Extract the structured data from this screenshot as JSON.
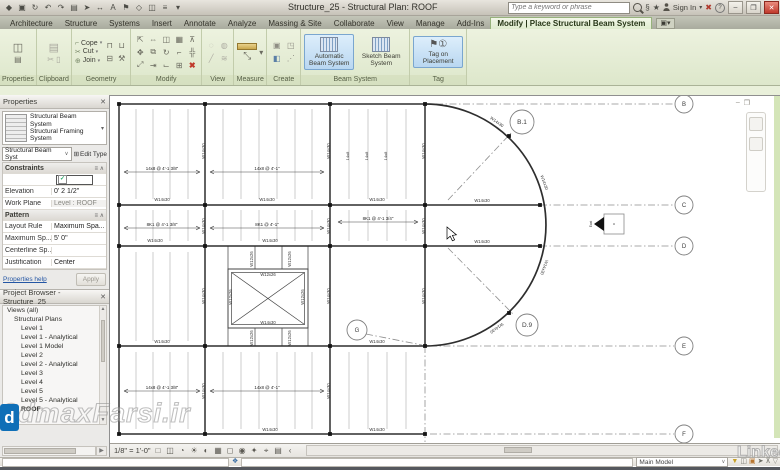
{
  "titlebar": {
    "title": "Structure_25 - Structural Plan: ROOF",
    "search_placeholder": "Type a keyword or phrase",
    "sign_in": "Sign In",
    "qat_icons": [
      "revit-app",
      "save",
      "sync",
      "undo",
      "redo",
      "print",
      "modify-arrow",
      "measure",
      "text",
      "tag-qat",
      "view-3d",
      "section",
      "thin-lines",
      "qat-customize"
    ],
    "window_buttons": [
      "minimize",
      "restore",
      "close"
    ]
  },
  "ribbon_tabs": [
    "Architecture",
    "Structure",
    "Systems",
    "Insert",
    "Annotate",
    "Analyze",
    "Massing & Site",
    "Collaborate",
    "View",
    "Manage",
    "Add-Ins"
  ],
  "contextual_tab": "Modify | Place Structural Beam System",
  "ribbon": {
    "panel_labels": [
      "Properties",
      "Clipboard",
      "Geometry",
      "Modify",
      "View",
      "Measure",
      "Create",
      "Beam System",
      "Tag"
    ],
    "geometry_buttons": [
      "Cope",
      "Cut",
      "Join"
    ],
    "beam_buttons": [
      {
        "label": "Automatic Beam System",
        "highlight": true
      },
      {
        "label": "Sketch Beam System",
        "highlight": false
      }
    ],
    "tag_button": "Tag on Placement"
  },
  "properties": {
    "title": "Properties",
    "type_name_line1": "Structural Beam System",
    "type_name_line2": "Structural Framing System",
    "selector": "Structural Beam Syst",
    "edit_type": "Edit Type",
    "rows": [
      {
        "t": "sec",
        "l": "Constraints"
      },
      {
        "t": "check",
        "l": "",
        "v": "✓"
      },
      {
        "t": "row",
        "l": "Elevation",
        "v": "0' 2 1/2\""
      },
      {
        "t": "rowg",
        "l": "Work Plane",
        "v": "Level : ROOF"
      },
      {
        "t": "sec",
        "l": "Pattern"
      },
      {
        "t": "row",
        "l": "Layout Rule",
        "v": "Maximum Spa..."
      },
      {
        "t": "row",
        "l": "Maximum Sp...",
        "v": "5' 0\""
      },
      {
        "t": "rowg",
        "l": "Centerline Sp...",
        "v": ""
      },
      {
        "t": "row",
        "l": "Justification",
        "v": "Center"
      }
    ],
    "help": "Properties help",
    "apply": "Apply"
  },
  "browser": {
    "title": "Project Browser - Structure_25",
    "items": [
      {
        "label": "Views (all)",
        "indent": 0
      },
      {
        "label": "Structural Plans",
        "indent": 1
      },
      {
        "label": "Level 1",
        "indent": 2
      },
      {
        "label": "Level 1 - Analytical",
        "indent": 2
      },
      {
        "label": "Level 1 Model",
        "indent": 2
      },
      {
        "label": "Level 2",
        "indent": 2
      },
      {
        "label": "Level 2 - Analytical",
        "indent": 2
      },
      {
        "label": "Level 3",
        "indent": 2
      },
      {
        "label": "Level 4",
        "indent": 2
      },
      {
        "label": "Level 5",
        "indent": 2
      },
      {
        "label": "Level 5 - Analytical",
        "indent": 2
      },
      {
        "label": "ROOF",
        "indent": 2,
        "selected": true
      }
    ]
  },
  "viewbar": {
    "scale": "1/8\" = 1'-0\"",
    "icons": [
      "visual-style",
      "show-crop",
      "crop-region",
      "sun-path",
      "shadows",
      "rendering",
      "temporary-hide",
      "reveal-hidden",
      "worksharing-display",
      "constraints",
      "analytical-model",
      "more"
    ]
  },
  "statusbar": {
    "main_model": "Main Model",
    "icons": [
      "worksets",
      "design-options",
      "editable-only",
      "press-drag",
      "exclude-options",
      "filter"
    ]
  },
  "watermarks": {
    "site": "3dmaxFarsi.ir",
    "linkedin": "Linked",
    "logo_letter": "d"
  },
  "plan": {
    "w": 670,
    "h": 348,
    "beams": [
      [
        9,
        8,
        315,
        8
      ],
      [
        9,
        109,
        315,
        109
      ],
      [
        9,
        150,
        315,
        150
      ],
      [
        9,
        250,
        315,
        250
      ],
      [
        9,
        338,
        315,
        338
      ],
      [
        315,
        109,
        430,
        109
      ],
      [
        315,
        150,
        430,
        150
      ],
      [
        9,
        8,
        9,
        338
      ],
      [
        95,
        8,
        95,
        338
      ],
      [
        220,
        8,
        220,
        338
      ],
      [
        315,
        8,
        315,
        250
      ]
    ],
    "arc": "M 315 8 A 121 121 0 0 1 315 250",
    "dashes": [
      [
        326,
        8,
        564,
        8
      ],
      [
        430,
        109,
        564,
        109
      ],
      [
        430,
        150,
        564,
        150
      ],
      [
        320,
        250,
        564,
        250
      ],
      [
        320,
        338,
        564,
        338
      ],
      [
        315,
        250,
        315,
        346
      ],
      [
        338,
        104,
        402,
        36
      ],
      [
        338,
        152,
        404,
        219
      ],
      [
        256,
        238,
        312,
        249
      ]
    ],
    "joists": [
      {
        "y1": 13,
        "y2": 103,
        "xs": [
          26,
          43,
          60,
          78,
          113,
          131,
          149,
          167,
          185,
          202,
          239,
          258,
          277,
          296
        ]
      },
      {
        "y1": 114,
        "y2": 145,
        "xs": [
          26,
          43,
          60,
          78,
          113,
          131,
          149,
          167,
          185,
          202,
          239,
          258,
          277,
          296
        ]
      },
      {
        "y1": 156,
        "y2": 245,
        "xs": [
          26,
          43,
          60,
          78
        ]
      },
      {
        "y1": 256,
        "y2": 333,
        "xs": [
          26,
          43,
          60,
          78,
          113,
          131,
          149,
          167,
          185,
          202,
          239,
          258,
          277,
          296
        ]
      }
    ],
    "stubs": [
      {
        "y1": 150,
        "y2": 173,
        "xs": [
          118,
          145,
          172,
          198
        ]
      },
      {
        "y1": 232,
        "y2": 250,
        "xs": [
          118,
          145,
          172,
          198
        ]
      }
    ],
    "dimtags": [
      [
        14,
        90,
        76,
        "14x8 @ 4'-1 3/8\""
      ],
      [
        100,
        214,
        76,
        "14x8 @ 4'-1\""
      ],
      [
        14,
        90,
        132,
        "8K1 @ 4'-1 3/8\""
      ],
      [
        100,
        214,
        132,
        "8K1 @ 4'-1\""
      ],
      [
        228,
        308,
        126,
        "8K1 @ 4'-1 3/4\""
      ],
      [
        14,
        90,
        295,
        "14x8 @ 4'-1 3/8\""
      ],
      [
        100,
        214,
        295,
        "14x8 @ 4'-1\""
      ]
    ],
    "labels": [
      [
        52,
        105,
        0,
        "W14x30"
      ],
      [
        157,
        105,
        0,
        "W14x30"
      ],
      [
        267,
        105,
        0,
        "W14x30"
      ],
      [
        372,
        106,
        0,
        "W14x30"
      ],
      [
        45,
        146,
        0,
        "W14x30"
      ],
      [
        160,
        146,
        0,
        "W14x30"
      ],
      [
        372,
        147,
        0,
        "W14x30"
      ],
      [
        52,
        247,
        0,
        "W14x30"
      ],
      [
        267,
        247,
        0,
        "W14x30"
      ],
      [
        160,
        335,
        0,
        "W14x30"
      ],
      [
        267,
        335,
        0,
        "W14x30"
      ],
      [
        95,
        55,
        -90,
        "W14x30"
      ],
      [
        95,
        130,
        -90,
        "W14x30"
      ],
      [
        95,
        200,
        -90,
        "W14x30"
      ],
      [
        95,
        295,
        -90,
        "W14x30"
      ],
      [
        220,
        55,
        -90,
        "W14x30"
      ],
      [
        220,
        130,
        -90,
        "W14x30"
      ],
      [
        220,
        200,
        -90,
        "W14x30"
      ],
      [
        220,
        295,
        -90,
        "W14x30"
      ],
      [
        315,
        55,
        -90,
        "W14x30"
      ],
      [
        315,
        130,
        -90,
        "W14x30"
      ],
      [
        315,
        200,
        -90,
        "W14x30"
      ],
      [
        239,
        60,
        -90,
        "14x8"
      ],
      [
        258,
        60,
        -90,
        "14x8"
      ],
      [
        277,
        60,
        -90,
        "14x8"
      ],
      [
        386,
        27,
        35,
        "W14x30"
      ],
      [
        433,
        87,
        70,
        "W14x30"
      ],
      [
        433,
        171,
        110,
        "W14x30"
      ],
      [
        386,
        231,
        145,
        "W14x30"
      ],
      [
        122,
        201,
        -90,
        "W12x26"
      ],
      [
        194,
        201,
        -90,
        "W12x26"
      ],
      [
        143,
        163,
        -90,
        "W12x26"
      ],
      [
        181,
        163,
        -90,
        "W12x26"
      ],
      [
        143,
        242,
        -90,
        "W12x26"
      ],
      [
        181,
        242,
        -90,
        "W12x26"
      ],
      [
        158,
        180,
        0,
        "W12x26"
      ],
      [
        158,
        228,
        0,
        "W14x30"
      ]
    ],
    "dots": [
      [
        9,
        8
      ],
      [
        95,
        8
      ],
      [
        220,
        8
      ],
      [
        315,
        8
      ],
      [
        9,
        109
      ],
      [
        95,
        109
      ],
      [
        220,
        109
      ],
      [
        315,
        109
      ],
      [
        430,
        109
      ],
      [
        9,
        150
      ],
      [
        95,
        150
      ],
      [
        220,
        150
      ],
      [
        315,
        150
      ],
      [
        430,
        150
      ],
      [
        9,
        250
      ],
      [
        95,
        250
      ],
      [
        220,
        250
      ],
      [
        315,
        250
      ],
      [
        9,
        338
      ],
      [
        95,
        338
      ],
      [
        220,
        338
      ],
      [
        315,
        338
      ],
      [
        399,
        40
      ],
      [
        399,
        217
      ]
    ],
    "bubbles": [
      [
        574,
        8,
        "B",
        9
      ],
      [
        574,
        109,
        "C",
        9
      ],
      [
        574,
        150,
        "D",
        9
      ],
      [
        574,
        250,
        "E",
        9
      ],
      [
        574,
        338,
        "F",
        9
      ],
      [
        412,
        26,
        "B.1",
        12
      ],
      [
        417,
        229,
        "D.9",
        11
      ],
      [
        247,
        234,
        "G",
        10
      ]
    ],
    "opening": {
      "x": 118,
      "y": 173,
      "w": 80,
      "h": 59
    },
    "elev_marker": {
      "x": 494,
      "y": 118,
      "label": "East"
    },
    "cursor": {
      "x": 337,
      "y": 131
    }
  }
}
